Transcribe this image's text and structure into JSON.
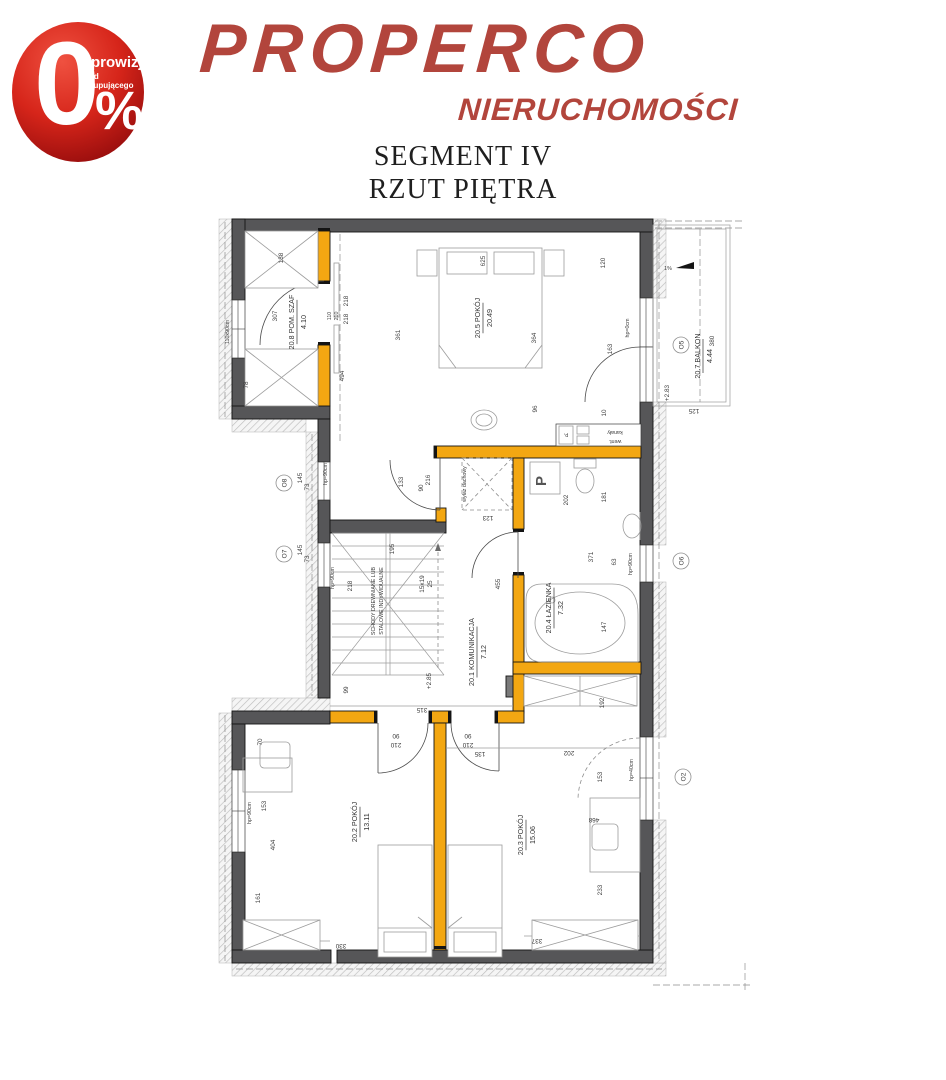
{
  "header": {
    "logo": "PROPERCO",
    "logo_sub": "NIERUCHOMOŚCI",
    "badge": {
      "zero": "0",
      "percent": "%",
      "line1": "prowizji",
      "line2": "od kupującego"
    },
    "colors": {
      "logo_red": "#B2453C",
      "badge_light": "#EF5140",
      "badge_dark": "#7C0A0C"
    }
  },
  "title": {
    "line1": "SEGMENT IV",
    "line2": "RZUT PIĘTRA"
  },
  "plan": {
    "colors": {
      "wall": "#565658",
      "partition_wall": "#F3A712",
      "hatch": "#BDBDBD"
    },
    "rooms": [
      {
        "id": "20.5",
        "name": "POKÓJ",
        "area": "20.49",
        "x": 483,
        "y": 318
      },
      {
        "id": "20.8",
        "name": "POM. SZAF",
        "area": "4.10",
        "x": 297,
        "y": 322
      },
      {
        "id": "20.7",
        "name": "BALKON",
        "area": "4.44",
        "x": 703,
        "y": 356
      },
      {
        "id": "20.4",
        "name": "ŁAZIENKA",
        "area": "7.32",
        "x": 554,
        "y": 608
      },
      {
        "id": "20.1",
        "name": "KOMUNIKACJA",
        "area": "7.12",
        "x": 477,
        "y": 652
      },
      {
        "id": "20.2",
        "name": "POKÓJ",
        "area": "13.11",
        "x": 360,
        "y": 822
      },
      {
        "id": "20.3",
        "name": "POKÓJ",
        "area": "15.06",
        "x": 526,
        "y": 835
      }
    ],
    "window_tags": [
      {
        "t": "O8",
        "x": 284,
        "y": 483
      },
      {
        "t": "O7",
        "x": 284,
        "y": 554
      },
      {
        "t": "O6",
        "x": 681,
        "y": 561
      },
      {
        "t": "O5",
        "x": 681,
        "y": 345
      },
      {
        "t": "O2",
        "x": 683,
        "y": 777
      }
    ],
    "dims": [
      {
        "t": "138",
        "x": 283,
        "y": 258,
        "r": -90
      },
      {
        "t": "625",
        "x": 485,
        "y": 261,
        "r": -90
      },
      {
        "t": "120",
        "x": 605,
        "y": 263,
        "r": -90
      },
      {
        "t": "361",
        "x": 400,
        "y": 335,
        "r": -90
      },
      {
        "t": "364",
        "x": 536,
        "y": 338,
        "r": -90
      },
      {
        "t": "163",
        "x": 612,
        "y": 349,
        "r": -90
      },
      {
        "t": "hp=0cm",
        "x": 629,
        "y": 328,
        "r": -90,
        "s": "small"
      },
      {
        "t": "96",
        "x": 537,
        "y": 409,
        "r": -90
      },
      {
        "t": "10",
        "x": 606,
        "y": 413,
        "r": -90
      },
      {
        "t": "307",
        "x": 277,
        "y": 316,
        "r": -90
      },
      {
        "t": "110x90cm",
        "x": 229,
        "y": 332,
        "r": -90,
        "s": "small"
      },
      {
        "t": "110",
        "x": 331,
        "y": 316,
        "r": -90,
        "s": "small"
      },
      {
        "t": "210",
        "x": 338,
        "y": 316,
        "r": -90,
        "s": "small"
      },
      {
        "t": "218",
        "x": 348,
        "y": 301,
        "r": -90
      },
      {
        "t": "218",
        "x": 348,
        "y": 319,
        "r": -90
      },
      {
        "t": "78",
        "x": 248,
        "y": 385,
        "r": -90
      },
      {
        "t": "494",
        "x": 344,
        "y": 376,
        "r": -90
      },
      {
        "t": "380",
        "x": 714,
        "y": 341,
        "r": -90
      },
      {
        "t": "+2.83",
        "x": 669,
        "y": 393,
        "r": -90
      },
      {
        "t": "125",
        "x": 694,
        "y": 409,
        "r": 180
      },
      {
        "t": "1%",
        "x": 668,
        "y": 270,
        "r": 0,
        "s": "small"
      },
      {
        "t": "145",
        "x": 302,
        "y": 478,
        "r": -90
      },
      {
        "t": "73",
        "x": 309,
        "y": 487,
        "r": -90
      },
      {
        "t": "hp=90cm",
        "x": 327,
        "y": 474,
        "r": -90,
        "s": "small"
      },
      {
        "t": "145",
        "x": 302,
        "y": 550,
        "r": -90
      },
      {
        "t": "73",
        "x": 309,
        "y": 559,
        "r": -90
      },
      {
        "t": "hp=90cm",
        "x": 334,
        "y": 578,
        "r": -90,
        "s": "small"
      },
      {
        "t": "133",
        "x": 403,
        "y": 482,
        "r": -90
      },
      {
        "t": "90",
        "x": 423,
        "y": 488,
        "r": -90
      },
      {
        "t": "216",
        "x": 430,
        "y": 480,
        "r": -90
      },
      {
        "t": "wyłaz dachowy",
        "x": 466,
        "y": 484,
        "r": -90,
        "s": "small"
      },
      {
        "t": "123",
        "x": 488,
        "y": 516,
        "r": 180
      },
      {
        "t": "218",
        "x": 352,
        "y": 586,
        "r": -90
      },
      {
        "t": "195",
        "x": 394,
        "y": 549,
        "r": -90
      },
      {
        "t": "15x19",
        "x": 424,
        "y": 584,
        "r": -90
      },
      {
        "t": "25",
        "x": 432,
        "y": 584,
        "r": -90
      },
      {
        "t": "99",
        "x": 348,
        "y": 690,
        "r": -90
      },
      {
        "t": "+2.85",
        "x": 431,
        "y": 681,
        "r": -90
      },
      {
        "t": "315",
        "x": 422,
        "y": 708,
        "r": 180
      },
      {
        "t": "202",
        "x": 568,
        "y": 500,
        "r": -90
      },
      {
        "t": "181",
        "x": 606,
        "y": 497,
        "r": -90
      },
      {
        "t": "371",
        "x": 593,
        "y": 557,
        "r": -90
      },
      {
        "t": "63",
        "x": 616,
        "y": 562,
        "r": -90
      },
      {
        "t": "147",
        "x": 606,
        "y": 627,
        "r": -90
      },
      {
        "t": "455",
        "x": 500,
        "y": 584,
        "r": -90
      },
      {
        "t": "192",
        "x": 604,
        "y": 703,
        "r": -90
      },
      {
        "t": "hp=90cm",
        "x": 632,
        "y": 564,
        "r": -90,
        "s": "small"
      },
      {
        "t": "90",
        "x": 396,
        "y": 734,
        "r": 180
      },
      {
        "t": "210",
        "x": 396,
        "y": 743,
        "r": 180
      },
      {
        "t": "90",
        "x": 468,
        "y": 734,
        "r": 180
      },
      {
        "t": "210",
        "x": 468,
        "y": 743,
        "r": 180
      },
      {
        "t": "135",
        "x": 480,
        "y": 752,
        "r": 180
      },
      {
        "t": "70",
        "x": 262,
        "y": 742,
        "r": -90
      },
      {
        "t": "153",
        "x": 266,
        "y": 806,
        "r": -90
      },
      {
        "t": "404",
        "x": 275,
        "y": 845,
        "r": -90
      },
      {
        "t": "161",
        "x": 260,
        "y": 898,
        "r": -90
      },
      {
        "t": "330",
        "x": 341,
        "y": 944,
        "r": 180
      },
      {
        "t": "hp=90cm",
        "x": 251,
        "y": 813,
        "r": -90,
        "s": "small"
      },
      {
        "t": "202",
        "x": 569,
        "y": 751,
        "r": 180
      },
      {
        "t": "153",
        "x": 602,
        "y": 777,
        "r": -90
      },
      {
        "t": "hp=40cm",
        "x": 633,
        "y": 770,
        "r": -90,
        "s": "small"
      },
      {
        "t": "468",
        "x": 594,
        "y": 818,
        "r": 180
      },
      {
        "t": "233",
        "x": 602,
        "y": 890,
        "r": -90
      },
      {
        "t": "337",
        "x": 537,
        "y": 939,
        "r": 180
      },
      {
        "t": "kanały",
        "x": 615,
        "y": 431,
        "r": 180,
        "s": "small"
      },
      {
        "t": "went.",
        "x": 615,
        "y": 440,
        "r": 180,
        "s": "small"
      },
      {
        "t": "p,",
        "x": 566,
        "y": 434,
        "r": 180,
        "s": "small"
      },
      {
        "t": "P",
        "x": 546,
        "y": 481,
        "r": -90,
        "s": "big"
      },
      {
        "t": "SCHODY DREWNIANE LUB",
        "x": 375,
        "y": 601,
        "r": -90,
        "s": "small"
      },
      {
        "t": "STALOWE INDYWIDUALNE",
        "x": 383,
        "y": 601,
        "r": -90,
        "s": "small"
      }
    ]
  }
}
